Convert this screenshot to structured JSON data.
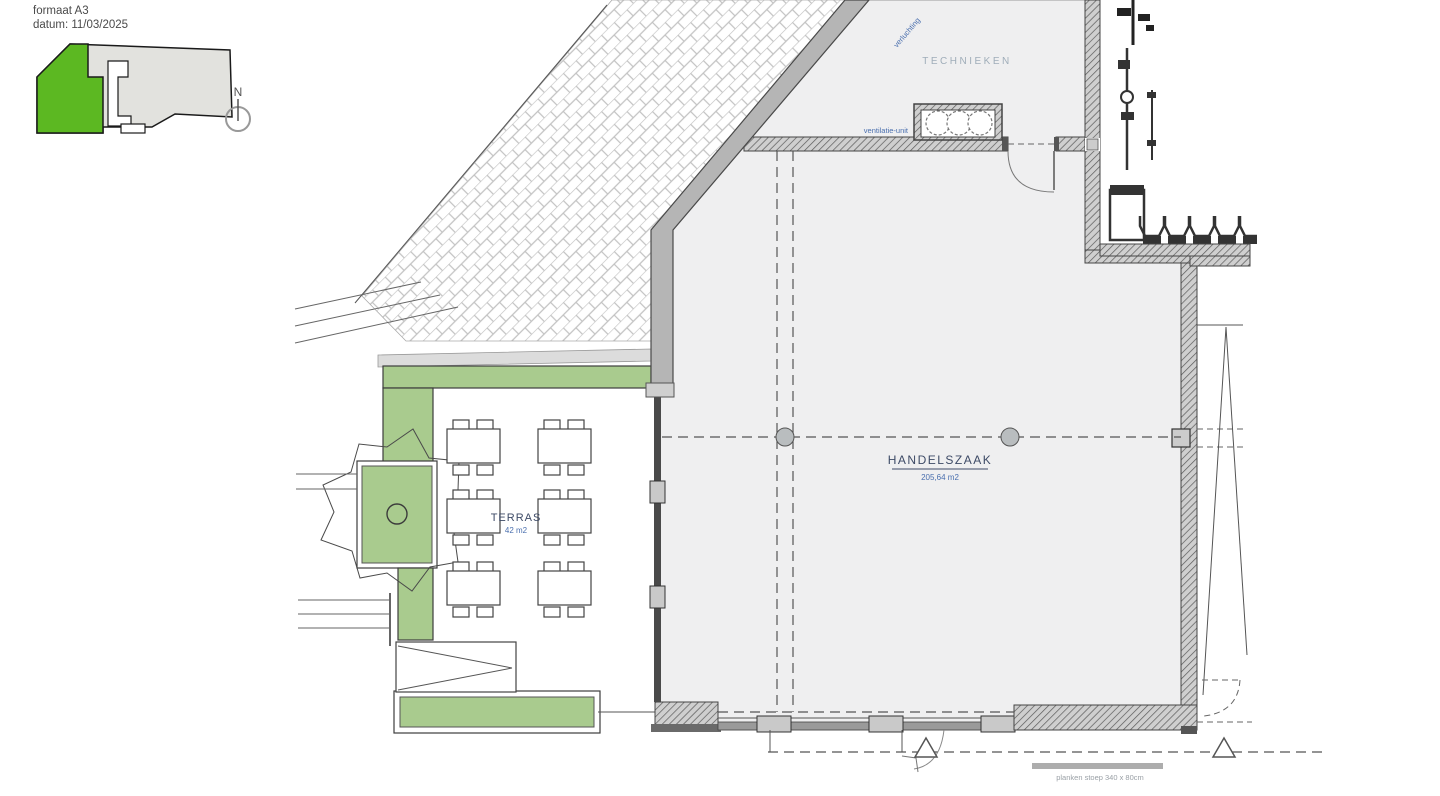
{
  "header": {
    "format": "formaat A3",
    "date": "datum: 11/03/2025"
  },
  "keyplan": {
    "north_label": "N"
  },
  "rooms": {
    "technieken": {
      "name": "TECHNIEKEN"
    },
    "handelszaak": {
      "name": "HANDELSZAAK",
      "area": "205,64 m2"
    },
    "terras": {
      "name": "TERRAS",
      "area": "42 m2"
    }
  },
  "annotations": {
    "ventilation_wall": "verluchting",
    "ventilation_unit": "ventilatie-unit",
    "entrance_platform": "planken stoep 340 x 80cm"
  },
  "colors": {
    "keyplan_green": "#5cb822",
    "planter_green": "#a9cb8e",
    "label_blue": "#4a6fae",
    "room_label": "#3d4a66",
    "faint_label": "#9fadb9"
  }
}
